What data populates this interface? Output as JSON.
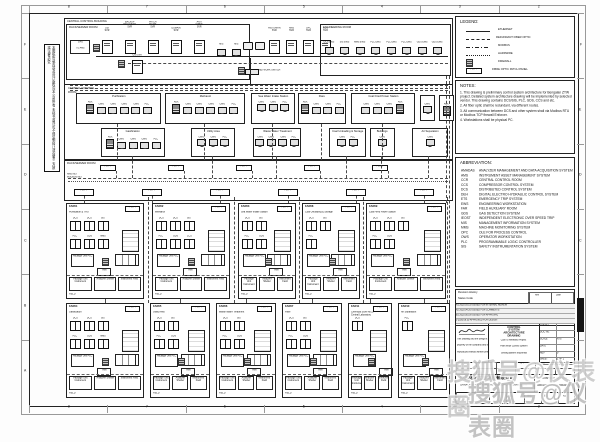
{
  "colors": {
    "paper": "#ffffff",
    "line": "#222222",
    "screen_gray": "#e2e2e2",
    "watermark": "#c4c4c4"
  },
  "frame": {
    "top_numbers": [
      "8",
      "7",
      "6",
      "5",
      "4",
      "3",
      "2"
    ],
    "bottom_numbers": [
      "8",
      "7",
      "6",
      "5",
      "4",
      "3",
      "2"
    ],
    "left_letters": [
      "F",
      "E",
      "D",
      "C",
      "B",
      "A"
    ],
    "right_letters": [
      "F",
      "E",
      "D",
      "C",
      "B",
      "A"
    ]
  },
  "side_note": {
    "line1": "本图纸所载内容及设计版权归本公司所有 未经书面许可不得复制转让或向第三方披露 违者必究",
    "line2": "THIS DRAWING AND THE DESIGN IT COVERS SHALL NOT BE REPRODUCED OR DISCLOSED WITHOUT WRITTEN PERMISSION"
  },
  "ccb": {
    "title": "CENTRAL CONTROL BUILDING",
    "rack_room_title": "RACK/SERVER ROOM",
    "eng_room_title": "ENGINEERING ROOM",
    "gps1": "GPS",
    "gps2": "TO AMS",
    "servers1": [
      "OSI SVR",
      "BACKUP RECOVERY SVR",
      "PATCH MGMT SVR",
      "DOMAIN SVR",
      "ANTI VIRUS SVR"
    ],
    "osi2": "OSI SVR",
    "monitors": [
      "MIS",
      "MIS"
    ],
    "servers2": [
      "HISTORIAN SVR",
      "AMS SVR",
      "OPC SVR",
      "GDS SVR"
    ],
    "network_switch": "NETWORK SWITCH",
    "ews": [
      "DCS EWS",
      "SIS EWS",
      "MMS EWS",
      "PLC EWS",
      "PLC EWS",
      "PLC EWS",
      "GDS EWS",
      "GDS EWS"
    ]
  },
  "ccr": {
    "title_1": "CENTRAL CONTROL",
    "title_2": "ROOM",
    "groups": [
      {
        "id": "purification",
        "label": "Purification",
        "monitors": [
          {
            "t": "aux",
            "l": "AUX"
          },
          {
            "t": "mon",
            "l": "OWS"
          },
          {
            "t": "mon",
            "l": "OWS"
          },
          {
            "t": "mon",
            "l": "OWS"
          },
          {
            "t": "mon",
            "l": "OWS"
          },
          {
            "t": "mon",
            "l": "PLC"
          }
        ]
      },
      {
        "id": "methanol",
        "label": "Methanol",
        "monitors": [
          {
            "t": "aux",
            "l": "AUX"
          },
          {
            "t": "mon",
            "l": "OWS"
          },
          {
            "t": "mon",
            "l": "OWS"
          },
          {
            "t": "mon",
            "l": "OWS"
          },
          {
            "t": "mon",
            "l": "OWS"
          },
          {
            "t": "mon",
            "l": "PLC"
          }
        ]
      },
      {
        "id": "swis",
        "label": "Sea Water Intake Station",
        "monitors": [
          {
            "t": "mon",
            "l": "OWS"
          },
          {
            "t": "mon",
            "l": "OWS"
          },
          {
            "t": "mon",
            "l": "PLC"
          }
        ]
      },
      {
        "id": "flare",
        "label": "Flare",
        "monitors": [
          {
            "t": "aux",
            "l": "AUX"
          },
          {
            "t": "mon",
            "l": "OWS"
          },
          {
            "t": "mon",
            "l": "OWS"
          },
          {
            "t": "mon",
            "l": "PLC"
          }
        ]
      },
      {
        "id": "cfps",
        "label": "Coal Fired Power Station",
        "monitors": [
          {
            "t": "mon",
            "l": "OWS"
          },
          {
            "t": "mon",
            "l": "OWS"
          },
          {
            "t": "mon",
            "l": "OWS"
          },
          {
            "t": "aux",
            "l": "AUX"
          }
        ]
      },
      {
        "id": "hist",
        "label": "",
        "monitors": [
          {
            "t": "mon",
            "l": "OWS"
          }
        ]
      },
      {
        "id": "aux-r",
        "label": "",
        "monitors": [
          {
            "t": "aux",
            "l": "AUX"
          }
        ]
      },
      {
        "id": "gasification",
        "label": "Gasification",
        "monitors": [
          {
            "t": "aux",
            "l": "AUX"
          },
          {
            "t": "mon",
            "l": "OWS"
          },
          {
            "t": "mon",
            "l": "OWS"
          },
          {
            "t": "mon",
            "l": "OWS"
          },
          {
            "t": "mon",
            "l": "PLC"
          }
        ]
      },
      {
        "id": "utility",
        "label": "Utility Area",
        "monitors": [
          {
            "t": "mon",
            "l": "OWS"
          },
          {
            "t": "mon",
            "l": "OWS"
          },
          {
            "t": "mon",
            "l": "PLC"
          }
        ]
      },
      {
        "id": "wwt",
        "label": "Waste Water Treatment",
        "monitors": [
          {
            "t": "mon",
            "l": "OWS"
          },
          {
            "t": "mon",
            "l": "OWS"
          },
          {
            "t": "mon",
            "l": "OWS"
          },
          {
            "t": "mon",
            "l": "PLC"
          }
        ]
      },
      {
        "id": "cus",
        "label": "Coal Unloading & Storage",
        "monitors": [
          {
            "t": "mon",
            "l": "OWS"
          },
          {
            "t": "mon",
            "l": "PLC"
          }
        ]
      },
      {
        "id": "buildings",
        "label": "Buildings",
        "monitors": [
          {
            "t": "mon",
            "l": "OWS"
          }
        ]
      },
      {
        "id": "airsep",
        "label": "Air Separation",
        "monitors": [
          {
            "t": "mon",
            "l": "OWS"
          }
        ]
      }
    ]
  },
  "rack2": {
    "title": "RACK/SERVER ROOM",
    "bus1": "AMS NET",
    "bus2": "MODBUS NET",
    "fopp_top": [
      "FO PP",
      "FO PP",
      "FO PP",
      "FO PP",
      "FO PP"
    ],
    "fopp_bot": [
      "FO PP",
      "FO PP",
      "FO PP",
      "FO PP",
      "FO PP",
      "FO PP"
    ]
  },
  "far": {
    "fopp": "FO PP",
    "hmi": "HMI",
    "field_label": "FIELD",
    "pkg": "Package Unit PLC",
    "bottom1": "Package Unit Instrument",
    "bottom2": "Analyzer Shelter",
    "bottom3": "Instrument Field",
    "sections": [
      {
        "id": "far01",
        "code": "FAR01",
        "name": "Purification & TRU",
        "cabs1": [
          "DCS",
          "DCS",
          "SIS"
        ],
        "cabs2": [
          "PLC",
          "GDS",
          "MMS"
        ]
      },
      {
        "id": "far02",
        "code": "FAR02",
        "name": "Methanol",
        "cabs1": [
          "DCS",
          "DCS",
          "SIS"
        ],
        "cabs2": [
          "PLC",
          "GDS",
          "CCS"
        ]
      },
      {
        "id": "far03",
        "code": "FAR03",
        "name": "Sea Water Intake Station",
        "cabs1": [
          "DCS",
          "SIS"
        ],
        "cabs2": [
          "PLC",
          "GDS"
        ]
      },
      {
        "id": "far08",
        "code": "FAR08",
        "name": "Coal Unloading & Storage",
        "cabs1": [
          "DCS",
          "SIS"
        ],
        "cabs2": [
          "PLC"
        ]
      },
      {
        "id": "far09",
        "code": "FAR09",
        "name": "Coal Fired Power Station",
        "cabs1": [
          "DCS",
          "DCS",
          "SIS"
        ],
        "cabs2": [
          "PLC",
          "GDS"
        ]
      },
      {
        "id": "far04",
        "code": "FAR04",
        "name": "Gasification",
        "cabs1": [
          "DCS",
          "DCS",
          "SIS"
        ],
        "cabs2": [
          "PLC",
          "GDS",
          "MMS"
        ]
      },
      {
        "id": "far05",
        "code": "FAR05",
        "name": "Utility Area",
        "cabs1": [
          "DCS",
          "SIS"
        ],
        "cabs2": [
          "PLC",
          "GDS"
        ]
      },
      {
        "id": "far06",
        "code": "FAR06",
        "name": "Waste Water Treatment",
        "cabs1": [
          "DCS",
          "SIS"
        ],
        "cabs2": [
          "PLC",
          "GDS"
        ]
      },
      {
        "id": "far07",
        "code": "FAR07",
        "name": "Flare",
        "cabs1": [
          "DCS",
          "SIS"
        ],
        "cabs2": [
          "PLC",
          "GDS"
        ]
      },
      {
        "id": "far11",
        "code": "FAR11",
        "name": "Chemical Store MCC Central Laboratory",
        "cabs1": [
          "DCS"
        ],
        "cabs2": []
      },
      {
        "id": "far10",
        "code": "FAR10",
        "name": "Air Separation",
        "cabs1": [
          "PLC"
        ],
        "cabs2": []
      }
    ]
  },
  "legend": {
    "title": "LEGEND:",
    "fopp_text": "FO PP",
    "items": [
      {
        "style": "solid",
        "label": "ETHERNET"
      },
      {
        "style": "dashed",
        "label": "REDUNDANT FIBER OPTIC"
      },
      {
        "style": "dashdot",
        "label": "MODBUS"
      },
      {
        "style": "dotted",
        "label": "HARDWIRE"
      },
      {
        "style": "firewall",
        "label": "FIREWALL"
      },
      {
        "style": "fopp",
        "label": "FIBRE OPTIC PATCH PANEL"
      }
    ]
  },
  "notes": {
    "title": "NOTES:",
    "items": [
      "1. This drawing is preliminary control system architecture for Bengalan ZTW project. Detailed system architecture drawing will be implemented by selected vendor. This drawing contains DCS/SIS, PLC, GDS, CCS and etc.",
      "2. All fiber optic shall be redundant, via different routes.",
      "3. All communication between DCS and other system shall via Modbus RTU or Modbus TCP firewall Enforcer.",
      "4. Workstations shall be physical PC."
    ]
  },
  "abbreviation": {
    "title": "ABBREVIATION:",
    "items": [
      [
        "AMADAS",
        "ANALYZER MANAGEMENT AND DATA ACQUISITION SYSTEM"
      ],
      [
        "AMS",
        "INSTRUMENT ASSET MANAGEMENT SYSTEM"
      ],
      [
        "CCR",
        "CENTRAL CONTROL ROOM"
      ],
      [
        "CCS",
        "COMPRESSOR CONTROL SYSTEM"
      ],
      [
        "DCS",
        "DISTRIBUTED CONTROL SYSTEM"
      ],
      [
        "DEH",
        "DIGITAL ELECTRO HYDRAULIC CONTROL SYSTEM"
      ],
      [
        "ETS",
        "EMERGENCY TRIP SYSTEM"
      ],
      [
        "EWS",
        "ENGINEERING WORKSTATION"
      ],
      [
        "FAR",
        "FIELD AUXILIARY ROOM"
      ],
      [
        "GDS",
        "GAS DETECTION SYSTEM"
      ],
      [
        "IEOST",
        "INDEPENDENT ELECTRONIC OVER SPEED TRIP"
      ],
      [
        "MIS",
        "MANAGEMENT INFORMATION SYSTEM"
      ],
      [
        "MMS",
        "MACHINE MONITORING SYSTEM"
      ],
      [
        "OPC",
        "OLE FOR PROCESS CONTROL"
      ],
      [
        "OWS",
        "OPERATOR WORKSTATION"
      ],
      [
        "PLC",
        "PROGRAMMABLE LOGIC CONTROLLER"
      ],
      [
        "SIS",
        "SAFETY INSTRUMENTATION SYSTEM"
      ]
    ]
  },
  "titleblock": {
    "rev_history": "Revision History",
    "status_code": "Status Code",
    "rev_col1": "Rev",
    "rev_col2": "Date",
    "rev_rows": [
      "A1  2020.03.15  ISSUED FOR INTERNAL REVIEW",
      "A2  2020.04.20  ISSUED FOR COMMENTS",
      "B1  2020.05.18  ISSUED FOR APPROVAL",
      "0   2020.06.30  APPROVED FOR DESIGN"
    ],
    "property_note": [
      "This drawing and the design it covers are the",
      "property of the company and shall not be",
      "reproduced without written permission"
    ],
    "main_title": "CONTROL SYSTEM ARCHITECTURE DRAWING",
    "project_lines": [
      "Coal To Methanol Project",
      "Plant Wide Control System",
      "Serang Banten Indonesia"
    ],
    "fields": [
      [
        "JOB NO.",
        ""
      ],
      [
        "DOC NO.",
        ""
      ],
      [
        "SCALE",
        "NTS"
      ],
      [
        "DATE",
        ""
      ],
      [
        "REV",
        "0"
      ],
      [
        "SHEET",
        "1 OF 1"
      ]
    ],
    "sig_headers": [
      "DSN",
      "DWN",
      "CHK",
      "APP",
      "PM",
      "DATE"
    ],
    "company_cn": "中国化学工程集团有限公司",
    "company_en": "CHINA CHEMICAL ENGINEERING GROUP CORPORATION LTD.",
    "sub_company": "上海工程设计研究院",
    "dept_cells": [
      "设计",
      "校核",
      "审核",
      "批准"
    ],
    "final_title_1": "CONTROL SYSTEM",
    "final_title_2": "ARCHITECTURE DRAWING",
    "sheet_size": "A1"
  },
  "watermark": {
    "line1": "搜狐号@仪表圈",
    "line2": "搜狐号@仪表圈"
  }
}
